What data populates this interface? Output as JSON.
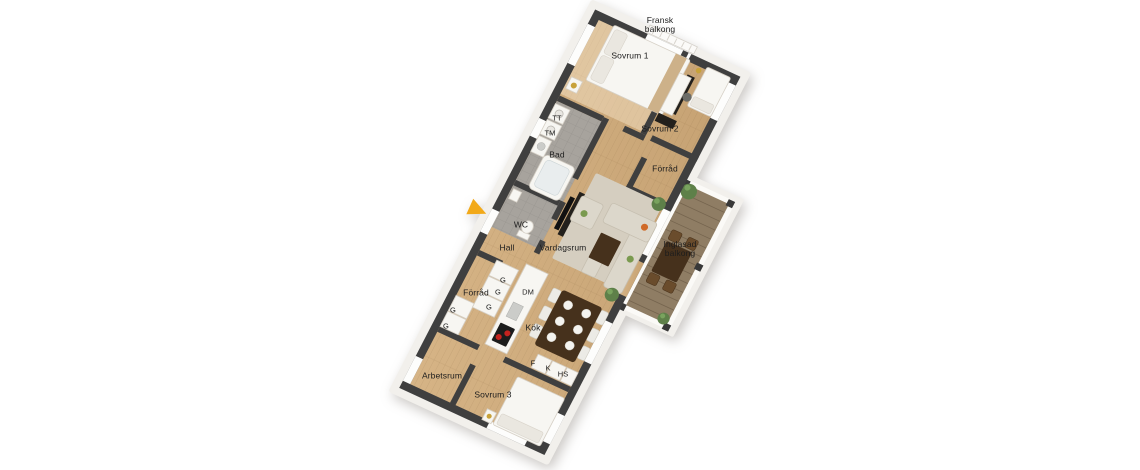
{
  "scene": {
    "type": "3d-floorplan-rendering",
    "background": "#ffffff"
  },
  "rooms": {
    "fransk_balkong": "Fransk balkong",
    "sovrum1": "Sovrum 1",
    "sovrum2": "Sovrum 2",
    "forrad_upper": "Förråd",
    "bad": "Bad",
    "wc": "WC",
    "hall": "Hall",
    "vardagsrum": "Vardagsrum",
    "inglasad_balkong": "Inglasad balkong",
    "forrad_lower": "Förråd",
    "kok": "Kök",
    "arbetsrum": "Arbetsrum",
    "sovrum3": "Sovrum 3"
  },
  "appliances": {
    "tt": "TT",
    "tm": "TM",
    "dm": "DM",
    "f": "F",
    "k": "K",
    "hs": "HS",
    "g": "G"
  },
  "colors": {
    "wall": "#3f3f3f",
    "plinth": "#f2f0ec",
    "floor_light": "#d6b486",
    "floor_dark": "#c6a273",
    "tile": "#a7a39d",
    "deck": "#8f7d64",
    "furniture_white": "#f7f6f2",
    "fw_stroke": "#d6d0c6",
    "sofa": "#dcd7cb",
    "rug": "#d5cec0",
    "dark_wood": "#46311c",
    "chair_wood": "#6a4c2c",
    "plant": "#5e8049",
    "gold": "#c8a23a",
    "arrow": "#f2a919",
    "label_text": "#1d1d1d"
  }
}
